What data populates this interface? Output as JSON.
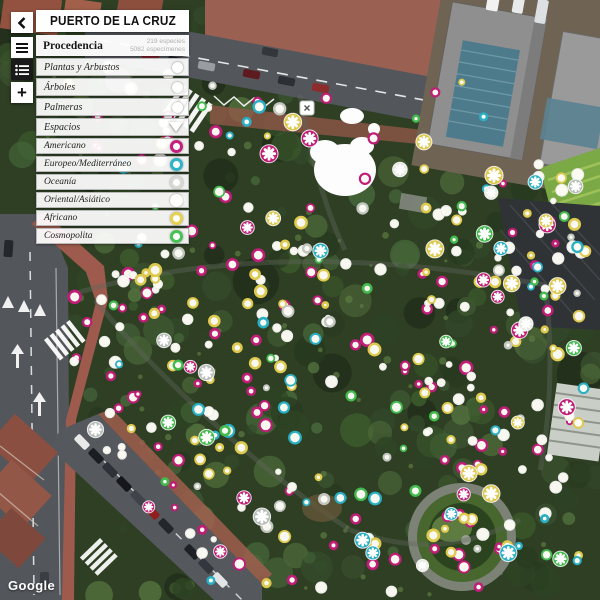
{
  "header": {
    "title": "PUERTO DE LA CRUZ"
  },
  "panel": {
    "section": {
      "title": "Procedencia",
      "species_count": "219 especies",
      "specimen_count": "5082 especímenes"
    },
    "filters": [
      {
        "label": "Plantas y Arbustos"
      },
      {
        "label": "Árboles"
      },
      {
        "label": "Palmeras"
      },
      {
        "label": "Espacios"
      }
    ],
    "categories": [
      {
        "label": "Americano",
        "color": "#c7207c"
      },
      {
        "label": "Europeo/Mediterráneo",
        "color": "#2fb3c7"
      },
      {
        "label": "Oceanía",
        "color": "#d8d8d4"
      },
      {
        "label": "Oriental/Asiático",
        "color": "#ffffff"
      },
      {
        "label": "Africano",
        "color": "#e6d24f"
      },
      {
        "label": "Cosmopolita",
        "color": "#49c254"
      }
    ]
  },
  "map": {
    "attribution": "Google",
    "markers": {
      "seed": 1337,
      "groups": [
        {
          "name": "americano",
          "color": "#bf1d76",
          "rings": 92,
          "stars": 13
        },
        {
          "name": "oriental-asiatico",
          "color": "#fdfdf8",
          "rings": 98,
          "stars": 4
        },
        {
          "name": "africano",
          "color": "#ddc94e",
          "rings": 72,
          "stars": 11
        },
        {
          "name": "europeo-mediterraneo",
          "color": "#2aafc4",
          "rings": 28,
          "stars": 7
        },
        {
          "name": "cosmopolita",
          "color": "#43b94e",
          "rings": 24,
          "stars": 6
        },
        {
          "name": "oceania",
          "color": "#c3c6c0",
          "rings": 22,
          "stars": 5
        }
      ]
    }
  }
}
